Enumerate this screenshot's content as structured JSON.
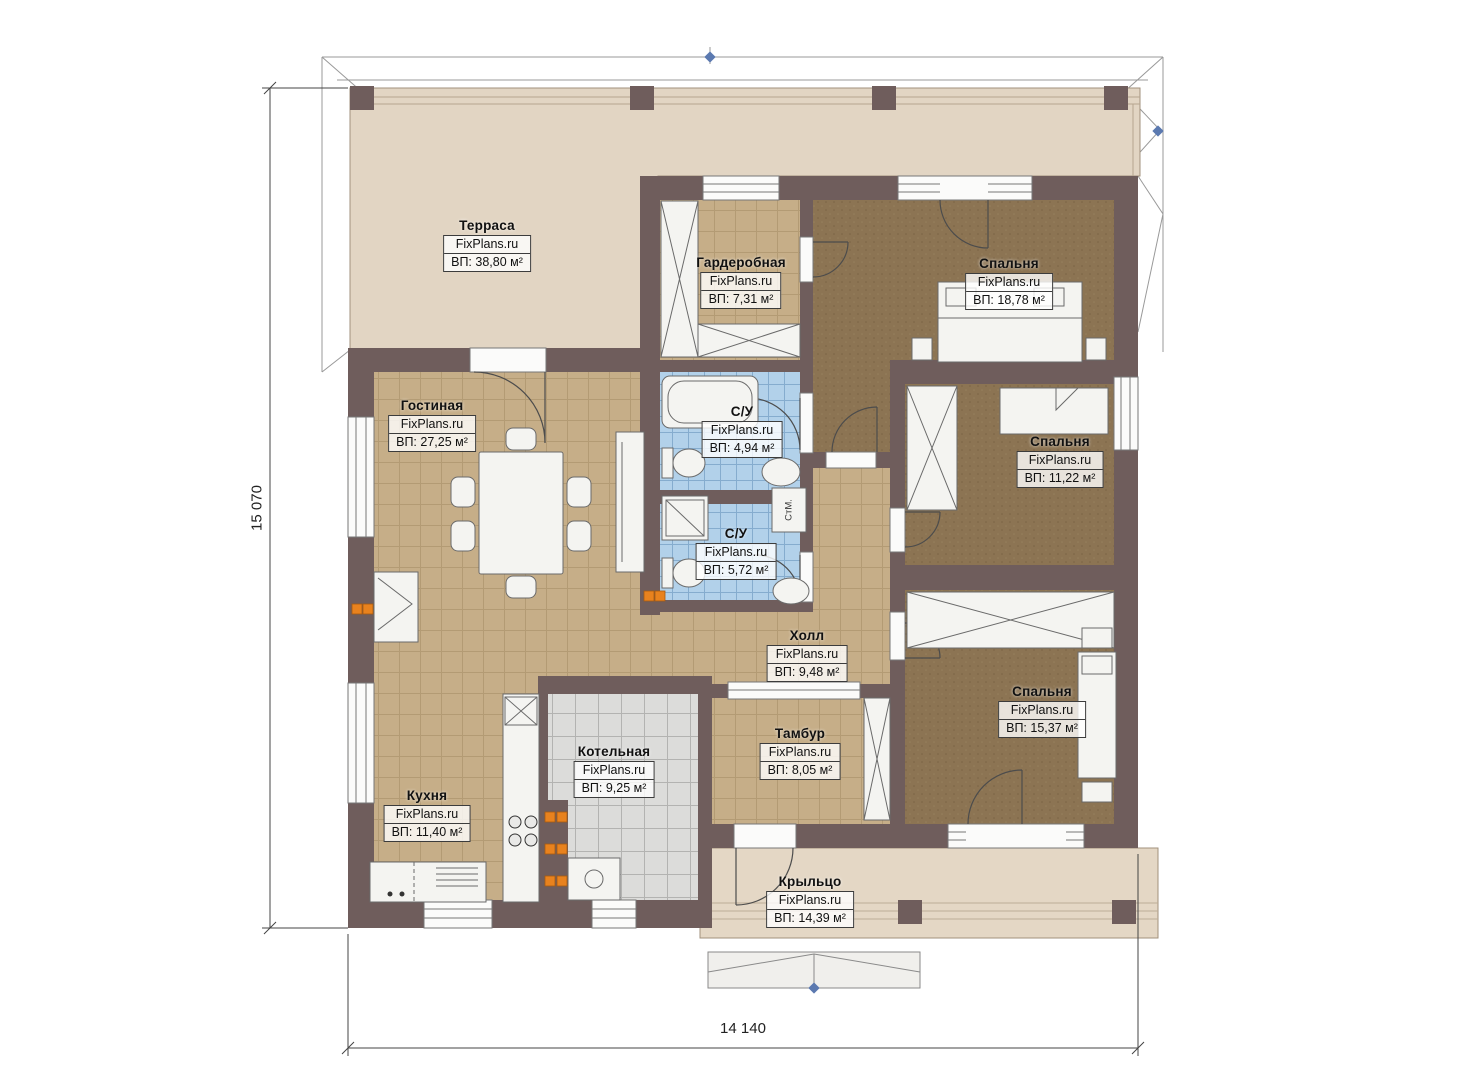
{
  "watermark": "FixPlans.ru",
  "dimensions": {
    "vertical": "15 070",
    "horizontal": "14 140"
  },
  "annotations": {
    "washing_machine": "СтМ."
  },
  "rooms": [
    {
      "name": "Терраса",
      "area": "ВП: 38,80 м²"
    },
    {
      "name": "Гардеробная",
      "area": "ВП: 7,31 м²"
    },
    {
      "name": "Спальня",
      "area": "ВП: 18,78 м²"
    },
    {
      "name": "Гостиная",
      "area": "ВП: 27,25 м²"
    },
    {
      "name": "С/У",
      "area": "ВП: 4,94 м²"
    },
    {
      "name": "Спальня",
      "area": "ВП: 11,22 м²"
    },
    {
      "name": "С/У",
      "area": "ВП: 5,72 м²"
    },
    {
      "name": "Холл",
      "area": "ВП: 9,48 м²"
    },
    {
      "name": "Тамбур",
      "area": "ВП: 8,05 м²"
    },
    {
      "name": "Спальня",
      "area": "ВП: 15,37 м²"
    },
    {
      "name": "Котельная",
      "area": "ВП: 9,25 м²"
    },
    {
      "name": "Кухня",
      "area": "ВП: 11,40 м²"
    },
    {
      "name": "Крыльцо",
      "area": "ВП: 14,39 м²"
    }
  ],
  "colors": {
    "wall": "#6f5d5c",
    "terrace": "#e2d5c3",
    "porch": "#e4d7c5",
    "tan_floor": "#c6ae88",
    "brown_floor": "#8c7453",
    "blue_tile": "#b2d1ea",
    "gray_tile": "#dcdcda",
    "accent_orange": "#e8821e",
    "marker_blue": "#5b79b0"
  }
}
